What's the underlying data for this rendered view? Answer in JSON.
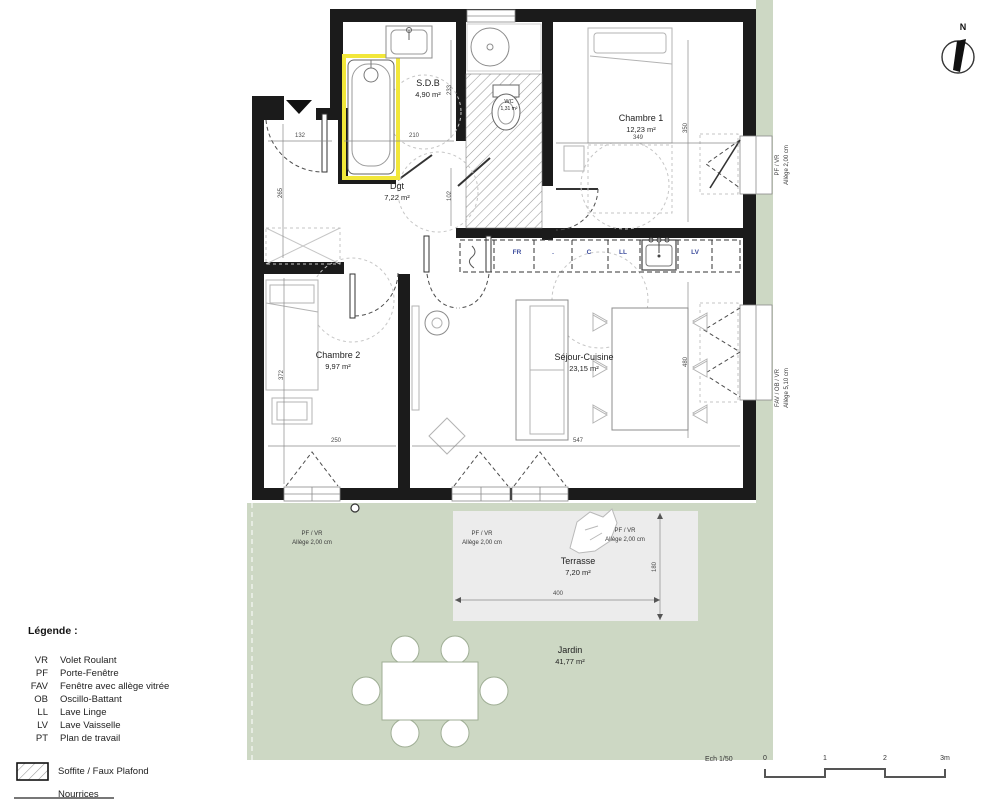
{
  "colors": {
    "green": "#cdd8c4",
    "terrace": "#ececec",
    "wall": "#1b1b1b",
    "furniture": "#b3b3b3",
    "furniture-dark": "#8c8c8c",
    "dash": "#c6c6c6",
    "dim": "#4a4a4a",
    "highlight": "#f2e73a",
    "kitchen-label": "#3f4f9e",
    "label": "#1f1f1f"
  },
  "rooms": {
    "sdb": {
      "name": "S.D.B",
      "area": "4,90 m²"
    },
    "wc": {
      "name": "WC",
      "area": "1,31 m²"
    },
    "chambre1": {
      "name": "Chambre 1",
      "area": "12,23 m²"
    },
    "dgt": {
      "name": "Dgt",
      "area": "7,22 m²"
    },
    "chambre2": {
      "name": "Chambre 2",
      "area": "9,97 m²"
    },
    "sejour": {
      "name": "Séjour-Cuisine",
      "area": "23,15 m²"
    },
    "terrasse": {
      "name": "Terrasse",
      "area": "7,20 m²"
    },
    "jardin": {
      "name": "Jardin",
      "area": "41,77 m²"
    }
  },
  "kitchen": {
    "fr": "FR",
    "dot": ".",
    "c": "C",
    "ll": "LL",
    "lv": "LV"
  },
  "dimensions": {
    "entry_w": "132",
    "entry_h": "265",
    "sdb_w": "210",
    "sdb_h": "233",
    "wc_h": "102",
    "ch1_w": "349",
    "ch1_h": "350",
    "ch2_w": "250",
    "ch2_h": "372",
    "sejour_w": "547",
    "sejour_h": "480",
    "terrasse_w": "400",
    "terrasse_h": "180"
  },
  "windows": {
    "right_top": {
      "line1": "PF / VR",
      "line2": "Allège  2,00 cm"
    },
    "right_bottom": {
      "line1": "FAV / OB / VR",
      "line2": "Allège  5,10 cm"
    },
    "garden_left": {
      "line1": "PF / VR",
      "line2": "Allège  2,00 cm"
    },
    "terrace_left": {
      "line1": "PF / VR",
      "line2": "Allège  2,00 cm"
    },
    "terrace_right": {
      "line1": "PF / VR",
      "line2": "Allège  2,00 cm"
    }
  },
  "legend": {
    "title": "Légende :",
    "items": [
      {
        "abbr": "VR",
        "label": "Volet Roulant"
      },
      {
        "abbr": "PF",
        "label": "Porte-Fenêtre"
      },
      {
        "abbr": "FAV",
        "label": "Fenêtre avec allège vitrée"
      },
      {
        "abbr": "OB",
        "label": "Oscillo-Battant"
      },
      {
        "abbr": "LL",
        "label": "Lave Linge"
      },
      {
        "abbr": "LV",
        "label": "Lave Vaisselle"
      },
      {
        "abbr": "PT",
        "label": "Plan de travail"
      }
    ],
    "soffite": "Soffite / Faux Plafond",
    "nourrices": "Nourrices"
  },
  "scalebar": {
    "label": "Ech 1/50",
    "ticks": [
      "0",
      "1",
      "2",
      "3m"
    ]
  },
  "compass": {
    "north": "N"
  }
}
